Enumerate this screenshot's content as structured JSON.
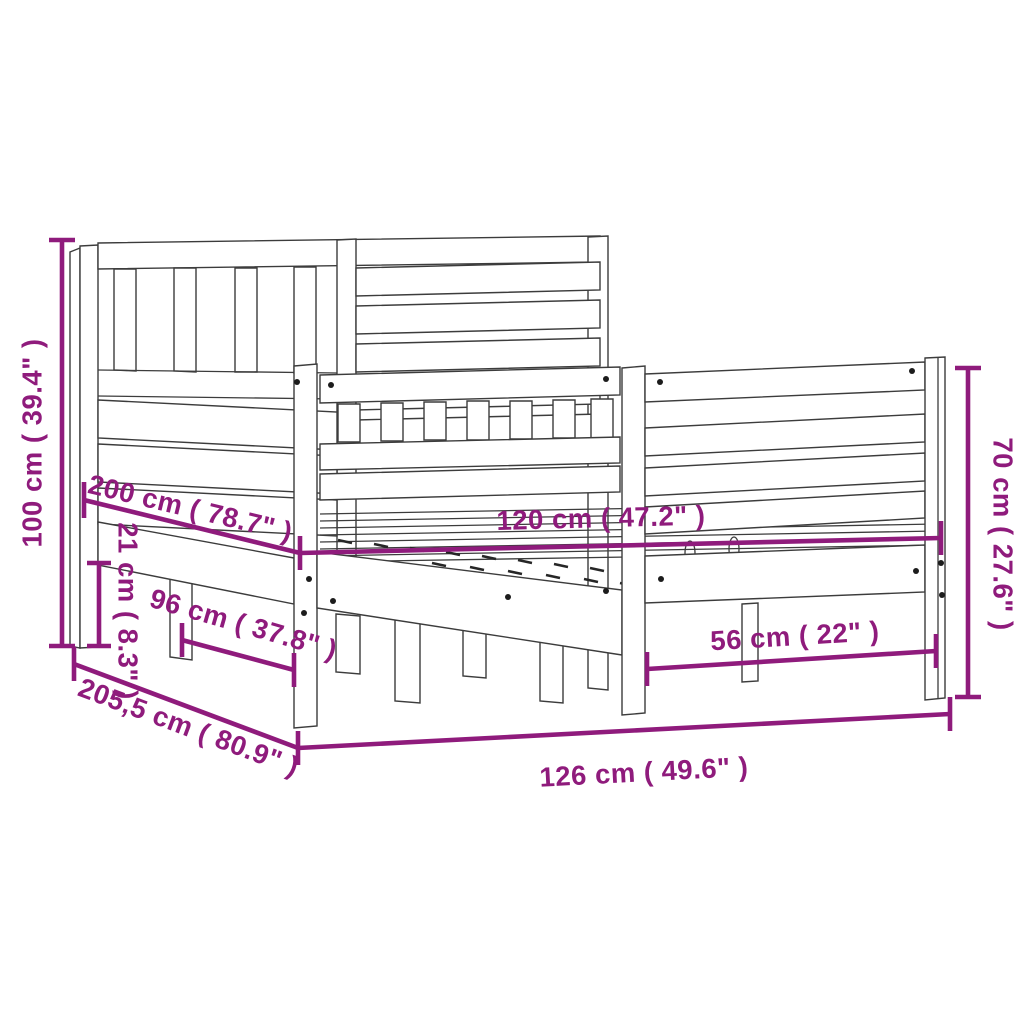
{
  "diagram": {
    "title": "bed-frame-dimension-diagram",
    "background": "#FFFFFF",
    "accent_color": "#8F1B7C",
    "line_color": "#3C3C3C",
    "dimensions": {
      "headboard_height": "100 cm ( 39.4\" )",
      "frame_length": "200 cm ( 78.7\" )",
      "mattress_width": "120 cm ( 47.2\" )",
      "under_bed_clearance": "21 cm ( 8.3\" )",
      "under_bed_depth": "96 cm ( 37.8\" )",
      "total_length": "205,5 cm ( 80.9\" )",
      "footboard_height": "70 cm ( 27.6\" )",
      "footboard_leg_span": "56 cm ( 22\" )",
      "total_width": "126 cm ( 49.6\" )"
    }
  }
}
